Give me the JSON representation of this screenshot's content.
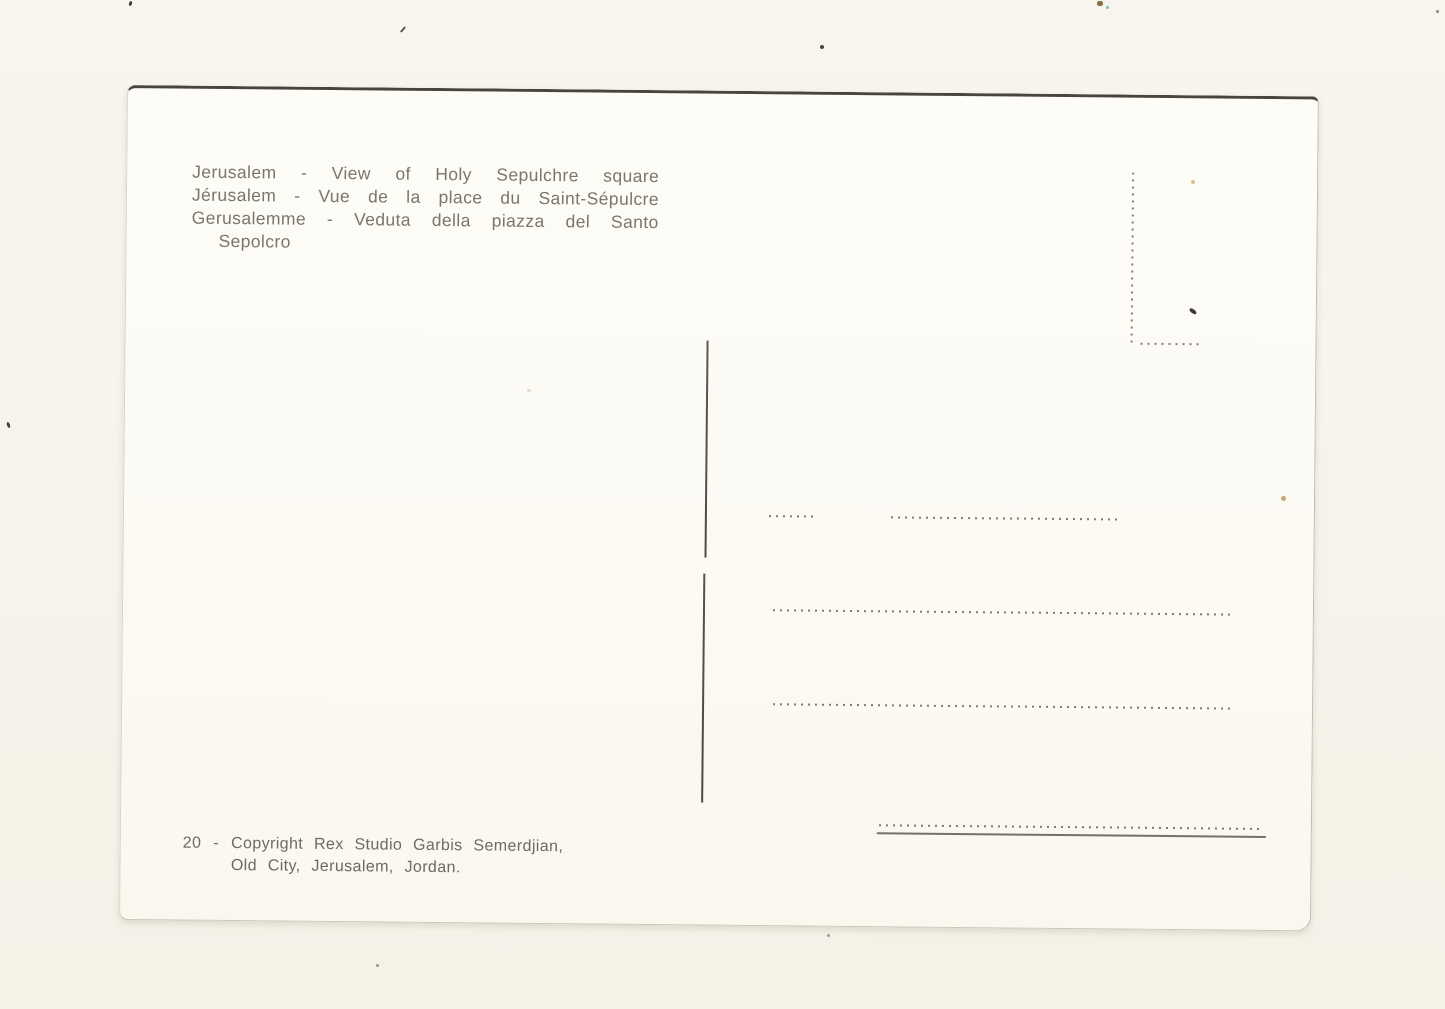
{
  "postcard": {
    "caption": {
      "lines": [
        "Jerusalem - View of Holy Sepulchre square",
        "Jérusalem - Vue de la place du Saint-Sépulcre",
        "Gerusalemme - Veduta della piazza del Santo",
        "Sepolcro"
      ]
    },
    "credit": {
      "number": "20",
      "separator": "-",
      "line1": "Copyright Rex Studio Garbis Semerdjian,",
      "line2": "Old City, Jerusalem, Jordan."
    },
    "colors": {
      "paper_background": "#f7f4ec",
      "card": "#fcfaf4",
      "ink_text": "#7b766c",
      "dotted_line": "#7f7a70",
      "divider_line": "#55504a",
      "card_top_edge": "#48443e"
    }
  }
}
